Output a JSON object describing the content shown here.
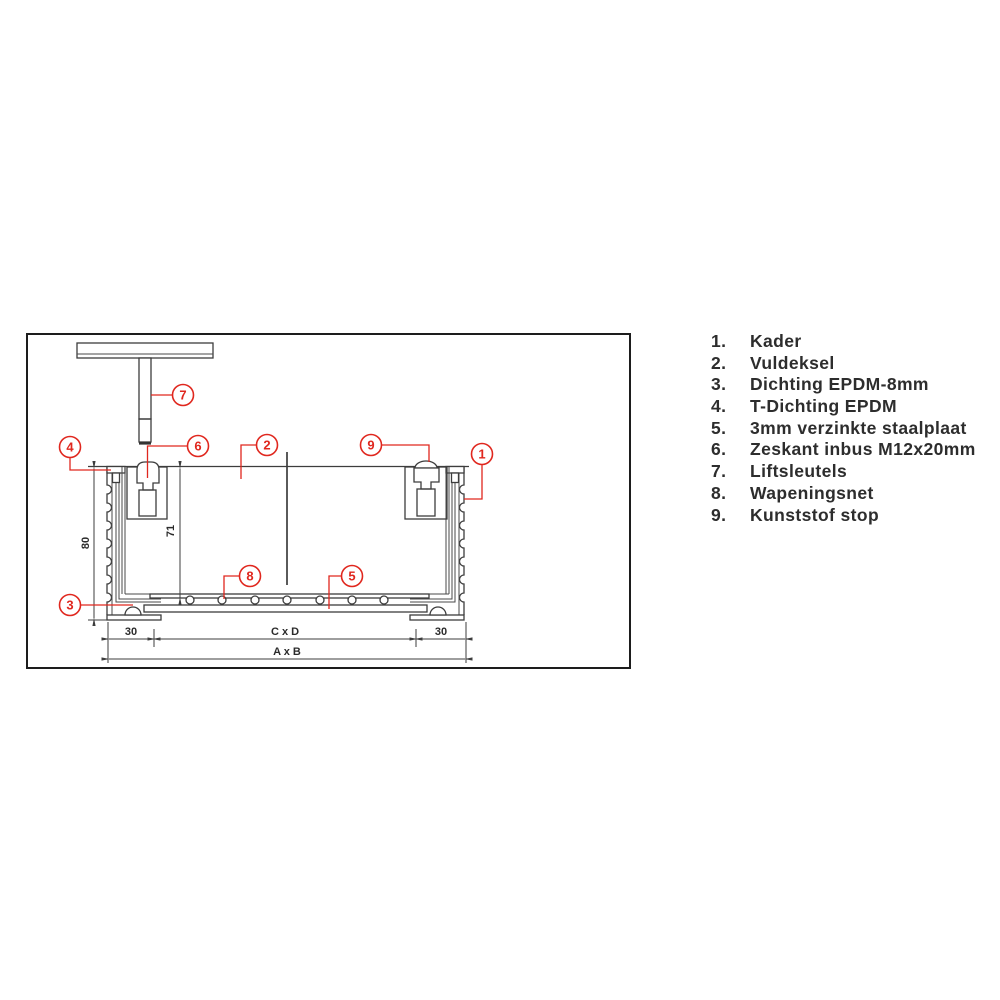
{
  "diagram": {
    "callouts": {
      "c1": "1",
      "c2": "2",
      "c3": "3",
      "c4": "4",
      "c5": "5",
      "c6": "6",
      "c7": "7",
      "c8": "8",
      "c9": "9"
    },
    "dimensions": {
      "frame_height": "80",
      "inner_height": "71",
      "rim_left": "30",
      "clear_opening": "C x D",
      "rim_right": "30",
      "overall_size": "A x B"
    }
  },
  "legend": {
    "items": [
      {
        "num": "1.",
        "label": "Kader"
      },
      {
        "num": "2.",
        "label": "Vuldeksel"
      },
      {
        "num": "3.",
        "label": "Dichting EPDM-8mm"
      },
      {
        "num": "4.",
        "label": "T-Dichting EPDM"
      },
      {
        "num": "5.",
        "label": "3mm verzinkte staalplaat"
      },
      {
        "num": "6.",
        "label": "Zeskant inbus M12x20mm"
      },
      {
        "num": "7.",
        "label": "Liftsleutels"
      },
      {
        "num": "8.",
        "label": "Wapeningsnet"
      },
      {
        "num": "9.",
        "label": "Kunststof stop"
      }
    ]
  },
  "colors": {
    "callout_red": "#e0271e",
    "line_dark": "#3d3d3d",
    "text": "#2b2b2b"
  }
}
